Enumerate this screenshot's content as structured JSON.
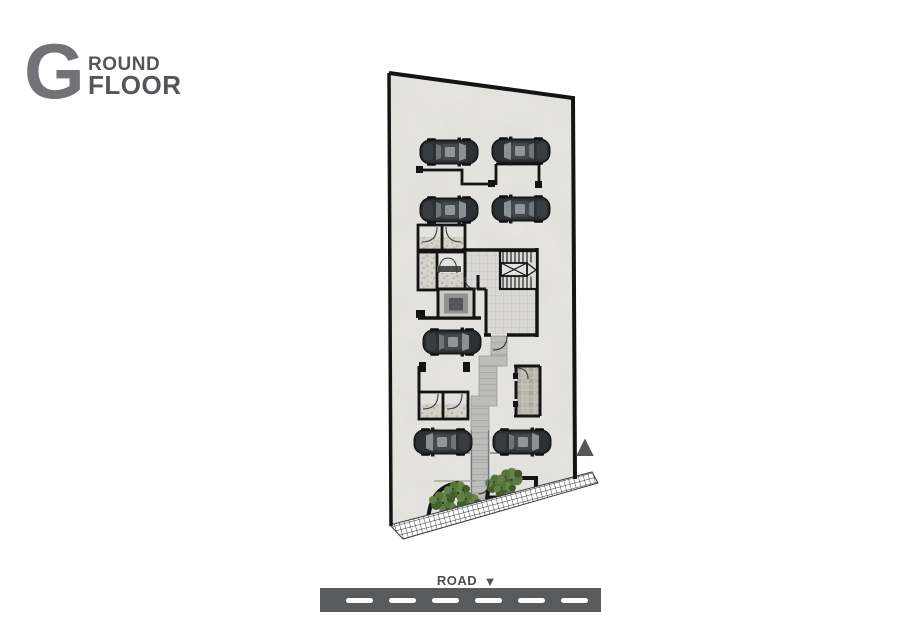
{
  "title": {
    "initial": "G",
    "rest_line1": "ROUND",
    "line2": "FLOOR"
  },
  "plan": {
    "floor_label": "Ground Floor",
    "north_arrow_symbol": "▲",
    "car_count": 7,
    "features": [
      "parking",
      "stairs",
      "elevator",
      "hall",
      "toilets",
      "store-room",
      "entrance-walkway",
      "planters",
      "sidewalk-ramp"
    ],
    "colors": {
      "wall": "#141414",
      "floor": "#e9e8e5",
      "hall_tile": "#d9d8d6",
      "walkway": "#bcbcba",
      "plant_green": "#557238",
      "car_body": "#242629",
      "elevator_core": "#54565a"
    }
  },
  "road": {
    "label": "ROAD",
    "direction_symbol": "▼",
    "dash_count": 6,
    "bar_color": "#595a5c",
    "dash_color": "#ffffff",
    "label_color": "#4c4e50"
  },
  "title_colors": {
    "initial": "#717376",
    "words": "#55565a"
  }
}
